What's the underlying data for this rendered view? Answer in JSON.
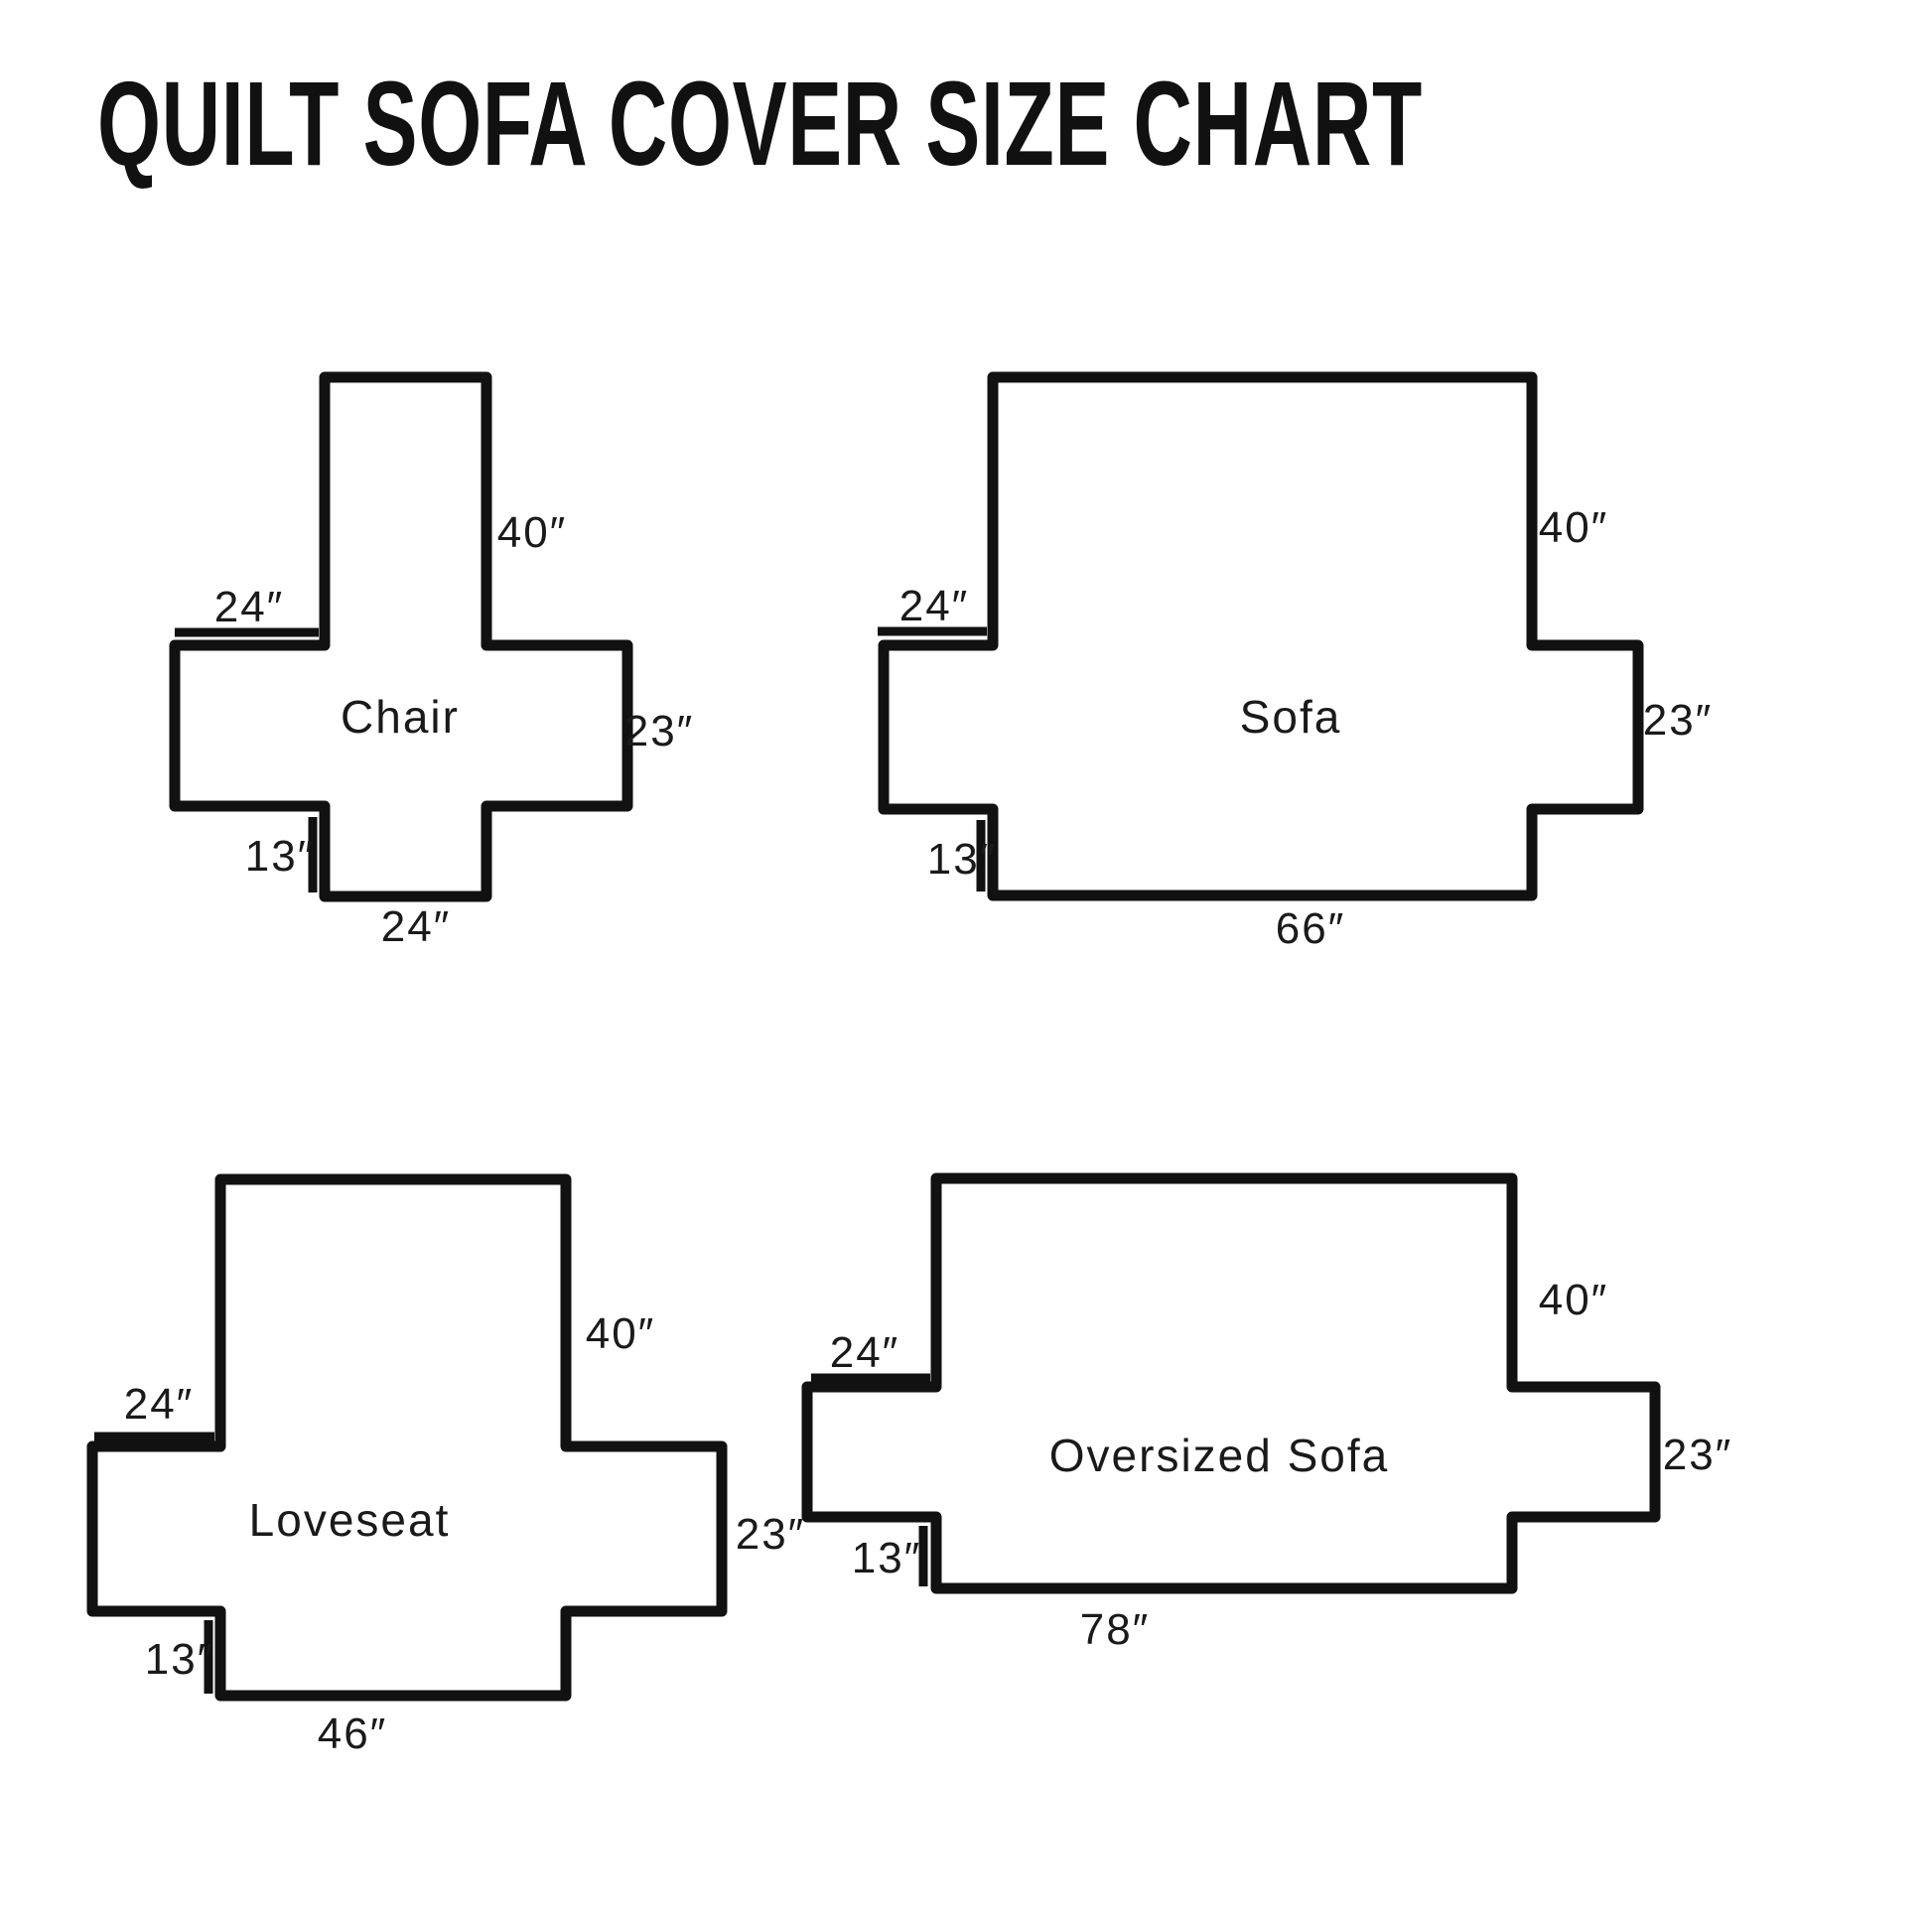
{
  "title": "QUILT SOFA COVER SIZE CHART",
  "colors": {
    "line": "#111111",
    "text": "#1a1a1a",
    "background": "#ffffff"
  },
  "diagrams": [
    {
      "name": "Chair",
      "back_height": "40″",
      "arm_top_width": "24″",
      "side_height": "23″",
      "front_drop": "13″",
      "seat_width": "24″"
    },
    {
      "name": "Sofa",
      "back_height": "40″",
      "arm_top_width": "24″",
      "side_height": "23″",
      "front_drop": "13″",
      "seat_width": "66″"
    },
    {
      "name": "Loveseat",
      "back_height": "40″",
      "arm_top_width": "24″",
      "side_height": "23″",
      "front_drop": "13″",
      "seat_width": "46″"
    },
    {
      "name": "Oversized Sofa",
      "back_height": "40″",
      "arm_top_width": "24″",
      "side_height": "23″",
      "front_drop": "13″",
      "seat_width": "78″"
    }
  ]
}
